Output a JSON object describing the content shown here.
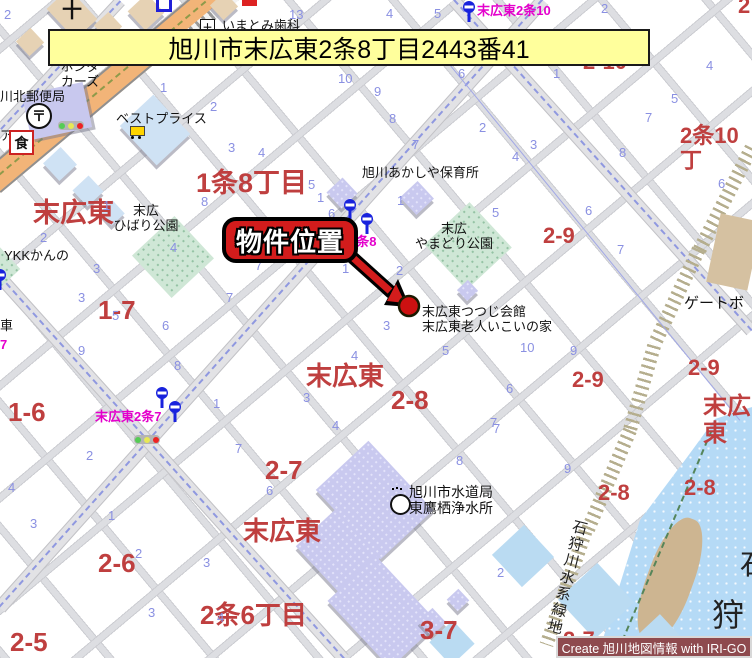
{
  "banner": {
    "text": "旭川市末広東2条8丁目2443番41"
  },
  "callout": {
    "label": "物件位置"
  },
  "credit": {
    "text": "Create 旭川地図情報 with IRI-GO"
  },
  "colors": {
    "banner_bg": "#ffff9c",
    "callout_red": "#d31c1c",
    "credit_bg": "#8e4a4e",
    "area_red": "#bf3f3f",
    "block_blue": "#8a90e2",
    "busstop_magenta": "#e400cc",
    "river_blue": "#b5daf6",
    "main_road_orange": "#f2b478",
    "park_green": "#cfe7d6"
  },
  "icons": {
    "post": "〒",
    "restaurant": "食",
    "church": "十",
    "hospital": "＋"
  },
  "map": {
    "greenbelt_label": "石狩川水系緑地",
    "red_labels": [
      {
        "t": "1条8丁目",
        "x": 196,
        "y": 168,
        "s": 27
      },
      {
        "t": "末広東",
        "x": 33,
        "y": 198,
        "s": 27
      },
      {
        "t": "1-7",
        "x": 98,
        "y": 296,
        "s": 26
      },
      {
        "t": "1-6",
        "x": 8,
        "y": 398,
        "s": 26
      },
      {
        "t": "末広東",
        "x": 306,
        "y": 362,
        "s": 26
      },
      {
        "t": "2-8",
        "x": 391,
        "y": 386,
        "s": 26
      },
      {
        "t": "2-7",
        "x": 265,
        "y": 456,
        "s": 26
      },
      {
        "t": "末広東",
        "x": 243,
        "y": 517,
        "s": 26
      },
      {
        "t": "2-6",
        "x": 98,
        "y": 549,
        "s": 26
      },
      {
        "t": "2-5",
        "x": 10,
        "y": 628,
        "s": 26
      },
      {
        "t": "2条6丁目",
        "x": 200,
        "y": 601,
        "s": 26
      },
      {
        "t": "3-7",
        "x": 420,
        "y": 616,
        "s": 26
      },
      {
        "t": "2-9",
        "x": 543,
        "y": 224,
        "s": 22
      },
      {
        "t": "2-9",
        "x": 572,
        "y": 368,
        "s": 22
      },
      {
        "t": "2-9",
        "x": 688,
        "y": 356,
        "s": 22
      },
      {
        "t": "2-8",
        "x": 598,
        "y": 481,
        "s": 22
      },
      {
        "t": "2-8",
        "x": 684,
        "y": 476,
        "s": 22
      },
      {
        "t": "2-7",
        "x": 563,
        "y": 628,
        "s": 22
      },
      {
        "t": "2-10",
        "x": 583,
        "y": 50,
        "s": 22
      },
      {
        "t": "2条10丁",
        "x": 680,
        "y": 124,
        "s": 22
      },
      {
        "t": "2",
        "x": 738,
        "y": -6,
        "s": 22
      },
      {
        "t": "末広東",
        "x": 703,
        "y": 394,
        "s": 24
      }
    ],
    "black_labels": [
      {
        "t": "いまとみ歯科",
        "x": 222,
        "y": 19
      },
      {
        "t": "ホンダ\nカーズ",
        "x": 50,
        "y": 60,
        "c": "ctr",
        "w": 60
      },
      {
        "t": "川北郵便局",
        "x": 0,
        "y": 90
      },
      {
        "t": "ベストプライス",
        "x": 116,
        "y": 112
      },
      {
        "t": "旭川あかしや保育所",
        "x": 362,
        "y": 166
      },
      {
        "t": "末広\nひばり公園",
        "x": 102,
        "y": 204,
        "c": "ctr",
        "w": 88
      },
      {
        "t": "末広\nやまどり公園",
        "x": 398,
        "y": 222,
        "c": "ctr",
        "w": 112
      },
      {
        "t": "YKKかんの",
        "x": 4,
        "y": 249
      },
      {
        "t": "末広東つつじ会館\n末広東老人いこいの家",
        "x": 422,
        "y": 305
      },
      {
        "t": "ゲートボ",
        "x": 684,
        "y": 296,
        "s": 15
      },
      {
        "t": "旭川市水道局\n東鷹栖浄水所",
        "x": 409,
        "y": 485,
        "s": 14
      },
      {
        "t": "車",
        "x": 0,
        "y": 319
      },
      {
        "t": "ア",
        "x": 0,
        "y": 129
      },
      {
        "t": "石",
        "x": 740,
        "y": 550,
        "s": 28,
        "c": "riv"
      },
      {
        "t": "狩",
        "x": 712,
        "y": 598,
        "s": 32,
        "c": "riv"
      }
    ],
    "magenta_labels": [
      {
        "t": "末広東2条10",
        "x": 477,
        "y": 4
      },
      {
        "t": "東2条8",
        "x": 336,
        "y": 235
      },
      {
        "t": "末広東2条7",
        "x": 95,
        "y": 410
      },
      {
        "t": "7",
        "x": 0,
        "y": 338
      }
    ],
    "blue_numbers": [
      {
        "t": "2",
        "x": 4,
        "y": 8
      },
      {
        "t": "13",
        "x": 289,
        "y": 8
      },
      {
        "t": "4",
        "x": 386,
        "y": 7
      },
      {
        "t": "5",
        "x": 434,
        "y": 7
      },
      {
        "t": "2",
        "x": 601,
        "y": 2
      },
      {
        "t": "1",
        "x": 160,
        "y": 81
      },
      {
        "t": "2",
        "x": 210,
        "y": 100
      },
      {
        "t": "10",
        "x": 338,
        "y": 72
      },
      {
        "t": "4",
        "x": 706,
        "y": 59
      },
      {
        "t": "3",
        "x": 228,
        "y": 141
      },
      {
        "t": "4",
        "x": 258,
        "y": 146
      },
      {
        "t": "9",
        "x": 374,
        "y": 85
      },
      {
        "t": "8",
        "x": 389,
        "y": 112
      },
      {
        "t": "7",
        "x": 412,
        "y": 138
      },
      {
        "t": "6",
        "x": 458,
        "y": 67
      },
      {
        "t": "1",
        "x": 553,
        "y": 67
      },
      {
        "t": "2",
        "x": 479,
        "y": 121
      },
      {
        "t": "3",
        "x": 530,
        "y": 138
      },
      {
        "t": "4",
        "x": 512,
        "y": 150
      },
      {
        "t": "5",
        "x": 671,
        "y": 92
      },
      {
        "t": "7",
        "x": 645,
        "y": 111
      },
      {
        "t": "8",
        "x": 619,
        "y": 146
      },
      {
        "t": "6",
        "x": 718,
        "y": 177
      },
      {
        "t": "6",
        "x": 585,
        "y": 204
      },
      {
        "t": "5",
        "x": 308,
        "y": 178
      },
      {
        "t": "8",
        "x": 201,
        "y": 195
      },
      {
        "t": "1",
        "x": 317,
        "y": 191
      },
      {
        "t": "6",
        "x": 328,
        "y": 207
      },
      {
        "t": "1",
        "x": 397,
        "y": 194
      },
      {
        "t": "5",
        "x": 492,
        "y": 206
      },
      {
        "t": "7",
        "x": 617,
        "y": 243
      },
      {
        "t": "1",
        "x": 103,
        "y": 199
      },
      {
        "t": "2",
        "x": 40,
        "y": 231
      },
      {
        "t": "3",
        "x": 93,
        "y": 262
      },
      {
        "t": "3",
        "x": 78,
        "y": 291
      },
      {
        "t": "4",
        "x": 170,
        "y": 241
      },
      {
        "t": "5",
        "x": 112,
        "y": 309
      },
      {
        "t": "6",
        "x": 162,
        "y": 319
      },
      {
        "t": "7",
        "x": 226,
        "y": 291
      },
      {
        "t": "7",
        "x": 255,
        "y": 259
      },
      {
        "t": "1",
        "x": 342,
        "y": 262
      },
      {
        "t": "2",
        "x": 396,
        "y": 264
      },
      {
        "t": "3",
        "x": 383,
        "y": 319
      },
      {
        "t": "4",
        "x": 351,
        "y": 349
      },
      {
        "t": "5",
        "x": 442,
        "y": 344
      },
      {
        "t": "10",
        "x": 520,
        "y": 341
      },
      {
        "t": "9",
        "x": 570,
        "y": 344
      },
      {
        "t": "6",
        "x": 506,
        "y": 382
      },
      {
        "t": "7",
        "x": 490,
        "y": 416
      },
      {
        "t": "3",
        "x": 303,
        "y": 391
      },
      {
        "t": "4",
        "x": 332,
        "y": 419
      },
      {
        "t": "9",
        "x": 78,
        "y": 344
      },
      {
        "t": "8",
        "x": 174,
        "y": 359
      },
      {
        "t": "1",
        "x": 213,
        "y": 397
      },
      {
        "t": "2",
        "x": 86,
        "y": 449
      },
      {
        "t": "7",
        "x": 235,
        "y": 442
      },
      {
        "t": "4",
        "x": 8,
        "y": 481
      },
      {
        "t": "6",
        "x": 266,
        "y": 484
      },
      {
        "t": "8",
        "x": 456,
        "y": 454
      },
      {
        "t": "7",
        "x": 493,
        "y": 422
      },
      {
        "t": "9",
        "x": 564,
        "y": 462
      },
      {
        "t": "3",
        "x": 30,
        "y": 517
      },
      {
        "t": "1",
        "x": 108,
        "y": 509
      },
      {
        "t": "2",
        "x": 135,
        "y": 547
      },
      {
        "t": "3",
        "x": 203,
        "y": 556
      },
      {
        "t": "3",
        "x": 148,
        "y": 606
      },
      {
        "t": "4",
        "x": 217,
        "y": 611
      },
      {
        "t": "2",
        "x": 497,
        "y": 566
      }
    ]
  }
}
